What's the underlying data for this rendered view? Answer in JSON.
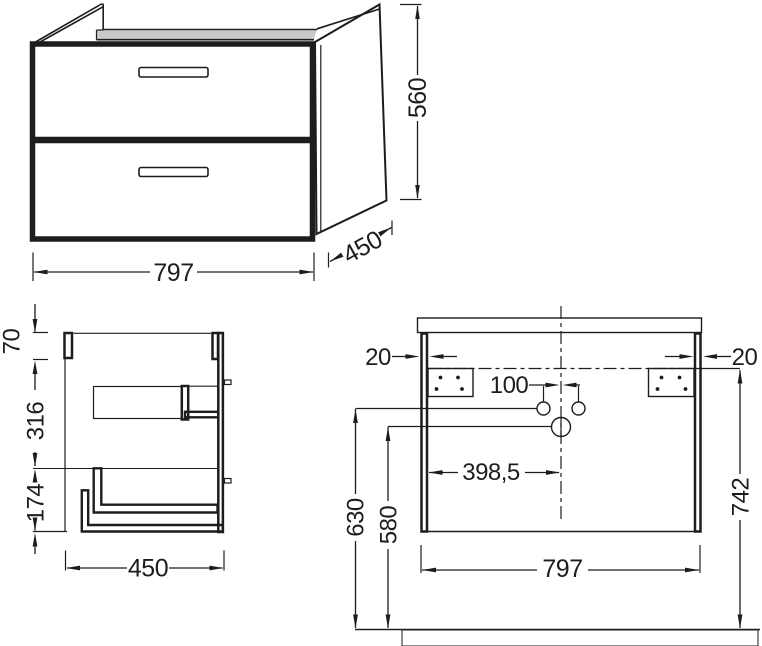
{
  "drawing": {
    "title": "vanity-unit-dimension-drawing",
    "line_color": "#1d1d1d",
    "rail_fill": "#c9c9c9",
    "front_view": {
      "width_label": "797",
      "height_label": "560",
      "depth_label": "450"
    },
    "side_view": {
      "top_offset_label": "70",
      "upper_section_label": "316",
      "lower_section_label": "174",
      "depth_label": "450"
    },
    "back_view": {
      "left_panel_thickness_label": "20",
      "right_panel_thickness_label": "20",
      "hole_spacing_label": "100",
      "center_offset_label": "398,5",
      "holes_height_label": "630",
      "outlet_height_label": "580",
      "fixing_height_label": "742",
      "width_label": "797"
    }
  }
}
